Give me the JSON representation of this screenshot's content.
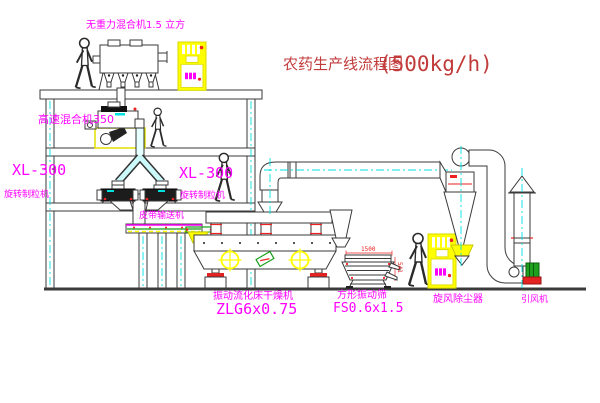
{
  "diagram": {
    "title": {
      "main": "农药生产线流程图",
      "capacity": "(500kg/h)"
    },
    "equipment_labels": {
      "gravity_mixer": "无重力混合机1.5 立方",
      "high_speed_mixer": "高速混合机350",
      "granulator_left_model": "XL-300",
      "granulator_left_name": "旋转制粒机",
      "granulator_right_model": "XL-300",
      "granulator_right_name": "旋转制粒机",
      "belt_conveyor": "皮带输送机",
      "fluid_bed_dryer": "振动流化床干燥机",
      "fluid_bed_dryer_model": "ZLG6x0.75",
      "square_vibrating_screen": "方形振动筛",
      "square_vibrating_screen_model": "FS0.6x1.5",
      "cyclone_dust_collector": "旋风除尘器",
      "induced_draft_fan": "引风机"
    },
    "dimensions": {
      "screen_length": "1500",
      "screen_height": "541"
    },
    "colors": {
      "label_magenta": "#ff00ff",
      "title_red": "#c23b3b",
      "outline": "#3a3a3a",
      "accent_yellow": "#ffff00",
      "accent_cyan": "#00e0e0",
      "accent_red": "#ee2222",
      "accent_green": "#19a019",
      "background": "#ffffff"
    }
  }
}
